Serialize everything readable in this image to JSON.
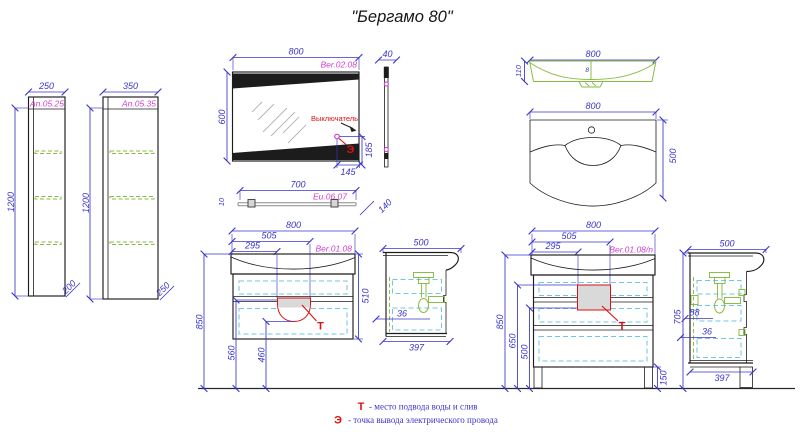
{
  "title": "\"Бергамо 80\"",
  "colors": {
    "dim": "#3a35cb",
    "code": "#cf3ecf",
    "accent_red": "#dd1111",
    "drawing_green": "#86bb3f",
    "hidden_cyan": "#6fc8de",
    "line_black": "#1c1c1c",
    "fill_gray": "#d9d9d9",
    "hatch_gray": "#b4b4b4"
  },
  "cabinets": {
    "small": {
      "width": "250",
      "code": "An.05.25",
      "height": "1200",
      "depth": "200"
    },
    "large": {
      "width": "350",
      "code": "An.05.35",
      "height": "1200",
      "depth": "250"
    }
  },
  "mirror": {
    "width": "800",
    "code": "Ber.02.08",
    "height": "600",
    "switch_label": "Выключатель",
    "switch_symbol": "Э",
    "switch_offset_v": "185",
    "switch_offset_h": "145",
    "side_width": "40",
    "side_depth": "140"
  },
  "shelf": {
    "width": "700",
    "code": "Eu.06.07",
    "thickness": "10"
  },
  "washbasin": {
    "top": {
      "width": "800",
      "depth": "110",
      "drain": "8"
    },
    "front": {
      "width": "800",
      "height": "500"
    }
  },
  "vanity_wall": {
    "width": "800",
    "drain_right": "505",
    "drain_left": "295",
    "code": "Ber.01.08",
    "height": "510",
    "mount_height": "850",
    "drain_top": "560",
    "drain_bottom": "460",
    "water_mark": "Т",
    "side": {
      "width": "500",
      "pipe_offset": "36",
      "depth": "397"
    }
  },
  "vanity_floor": {
    "width": "800",
    "drain_right": "505",
    "drain_left": "295",
    "code": "Ber.01.08/n",
    "mount_height": "850",
    "drain_top": "650",
    "drain_bottom": "500",
    "leg_height": "150",
    "water_mark": "Т",
    "side": {
      "width": "500",
      "height": "705",
      "dim_a": "88",
      "pipe_offset": "36",
      "depth": "397"
    }
  },
  "legend": {
    "water_symbol": "Т",
    "water_text": "- место подвода воды и слив",
    "electric_symbol": "Э",
    "electric_text": "- точка вывода электрического провода"
  }
}
